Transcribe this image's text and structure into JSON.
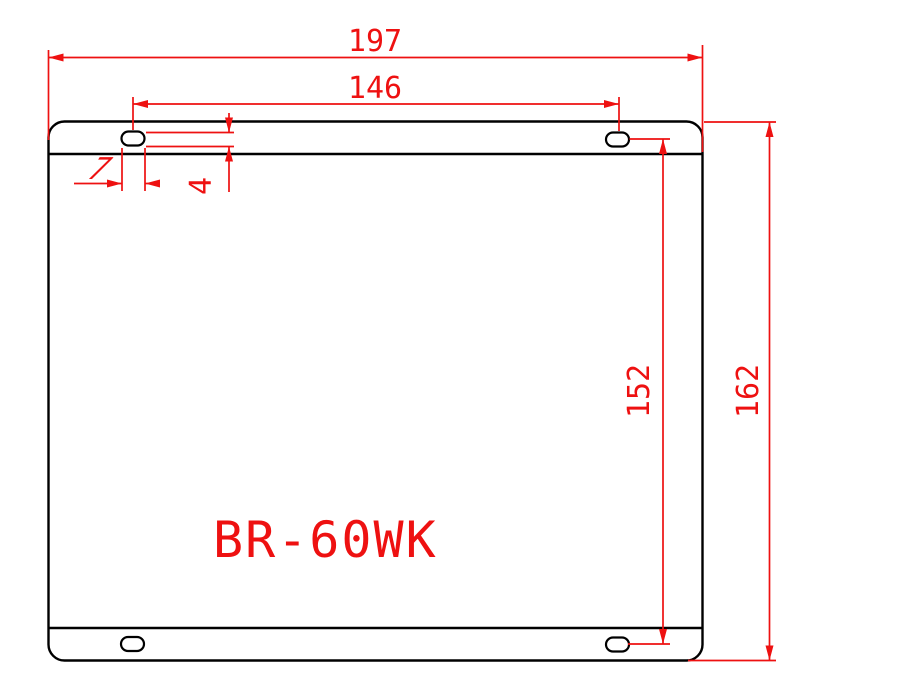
{
  "drawing": {
    "part_label": "BR-60WK",
    "dimensions": {
      "overall_width": "197",
      "hole_spacing_horizontal": "146",
      "overall_height": "162",
      "hole_spacing_vertical": "152",
      "slot_width": "7",
      "slot_height": "4"
    },
    "colors": {
      "dimension_red": "#ee1111",
      "outline_black": "#000000",
      "background": "#ffffff"
    }
  }
}
